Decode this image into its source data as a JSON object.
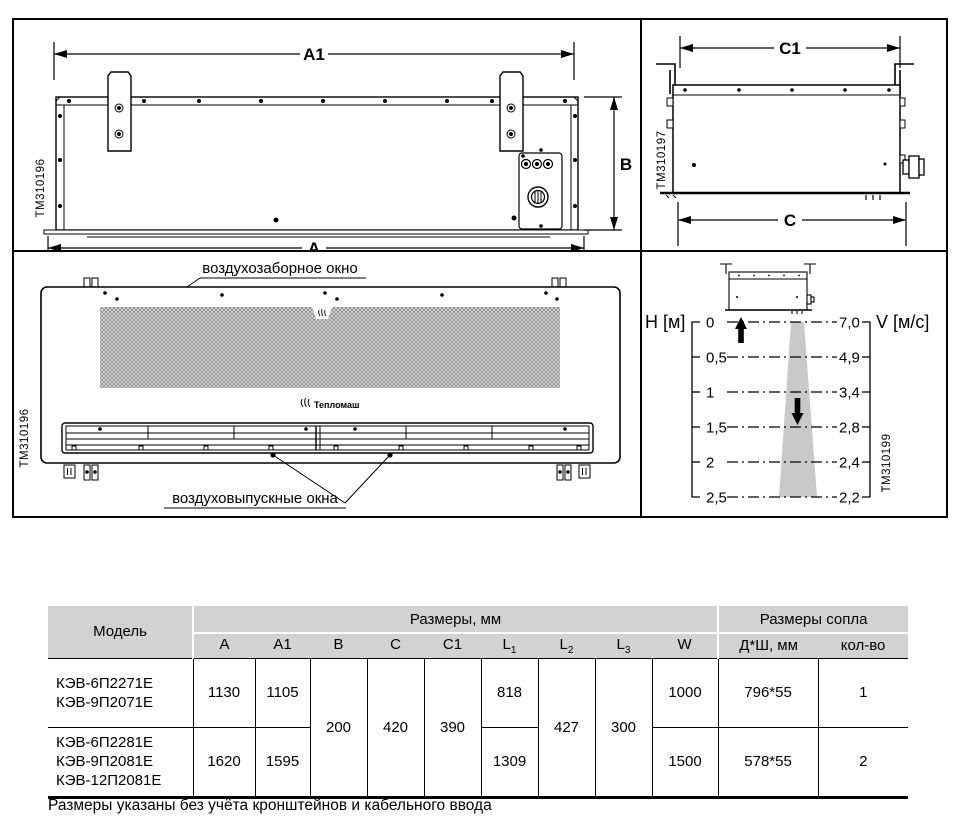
{
  "drawings": {
    "rear": {
      "code": "TM310196",
      "dim_a1": "A1",
      "dim_a": "A",
      "dim_b": "B"
    },
    "side": {
      "code": "TM310197",
      "dim_c1": "C1",
      "dim_c": "C"
    },
    "front": {
      "code": "TM310196",
      "intake_label": "воздухозаборное окно",
      "outlet_label": "воздуховыпускные окна",
      "logo": "Тепломаш"
    },
    "airflow": {
      "code": "TM310199",
      "h_axis": "H [м]",
      "v_axis": "V [м/с]",
      "h_ticks": [
        "0",
        "0,5",
        "1",
        "1,5",
        "2",
        "2,5"
      ],
      "v_ticks": [
        "7,0",
        "4,9",
        "3,4",
        "2,8",
        "2,4",
        "2,2"
      ]
    }
  },
  "chart_data": {
    "type": "line",
    "xlabel": "H [м]",
    "ylabel": "V [м/с]",
    "x": [
      0,
      0.5,
      1,
      1.5,
      2,
      2.5
    ],
    "series": [
      {
        "name": "V",
        "values": [
          7.0,
          4.9,
          3.4,
          2.8,
          2.4,
          2.2
        ]
      }
    ],
    "legend": "none",
    "grid": "dash-dot horizontal levels"
  },
  "table": {
    "header": {
      "model": "Модель",
      "dims_group": "Размеры, мм",
      "nozzle_group": "Размеры сопла",
      "cols": [
        {
          "t": "A"
        },
        {
          "t": "A1"
        },
        {
          "t": "B"
        },
        {
          "t": "C"
        },
        {
          "t": "C1"
        },
        {
          "t": "L",
          "sub": "1"
        },
        {
          "t": "L",
          "sub": "2"
        },
        {
          "t": "L",
          "sub": "3"
        },
        {
          "t": "W"
        }
      ],
      "nozzle_cols": [
        "Д*Ш, мм",
        "кол-во"
      ]
    },
    "rows": [
      {
        "models": [
          "КЭВ-6П2271Е",
          "КЭВ-9П2071Е"
        ],
        "a": "1130",
        "a1": "1105",
        "l1": "818",
        "w": "1000",
        "nozzle": "796*55",
        "count": "1"
      },
      {
        "models": [
          "КЭВ-6П2281Е",
          "КЭВ-9П2081Е",
          "КЭВ-12П2081Е"
        ],
        "a": "1620",
        "a1": "1595",
        "l1": "1309",
        "w": "1500",
        "nozzle": "578*55",
        "count": "2"
      }
    ],
    "merged": {
      "b": "200",
      "c": "420",
      "c1": "390",
      "l2": "427",
      "l3": "300"
    }
  },
  "footnote": "Размеры указаны без учёта кронштейнов и кабельного ввода"
}
